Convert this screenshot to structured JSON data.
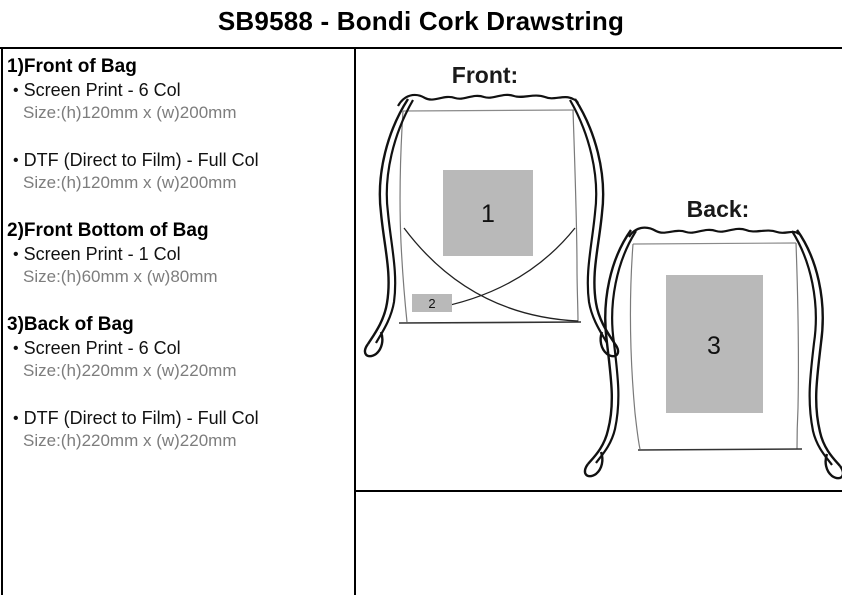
{
  "title": "SB9588 - Bondi Cork Drawstring",
  "left_panel": {
    "bullet_glyph": "•",
    "sections": [
      {
        "heading": "1)Front of Bag",
        "items": [
          {
            "method": "Screen Print - 6 Col",
            "size": "Size:(h)120mm x (w)200mm"
          },
          {
            "method": "DTF (Direct to Film) - Full Col",
            "size": "Size:(h)120mm x (w)200mm"
          }
        ]
      },
      {
        "heading": "2)Front Bottom of Bag",
        "items": [
          {
            "method": "Screen Print - 1 Col",
            "size": "Size:(h)60mm x (w)80mm"
          }
        ]
      },
      {
        "heading": "3)Back of Bag",
        "items": [
          {
            "method": "Screen Print - 6 Col",
            "size": "Size:(h)220mm x (w)220mm"
          },
          {
            "method": "DTF (Direct to Film) - Full Col",
            "size": "Size:(h)220mm x (w)220mm"
          }
        ]
      }
    ]
  },
  "diagram": {
    "front_label": "Front:",
    "back_label": "Back:",
    "print_areas": [
      {
        "number": "1",
        "location": "front"
      },
      {
        "number": "2",
        "location": "front-bottom"
      },
      {
        "number": "3",
        "location": "back"
      }
    ],
    "area_fill": "#b9b9b9"
  },
  "colors": {
    "size_text": "#7d7d7d",
    "line": "#000000",
    "print_area_gray": "#b9b9b9"
  }
}
